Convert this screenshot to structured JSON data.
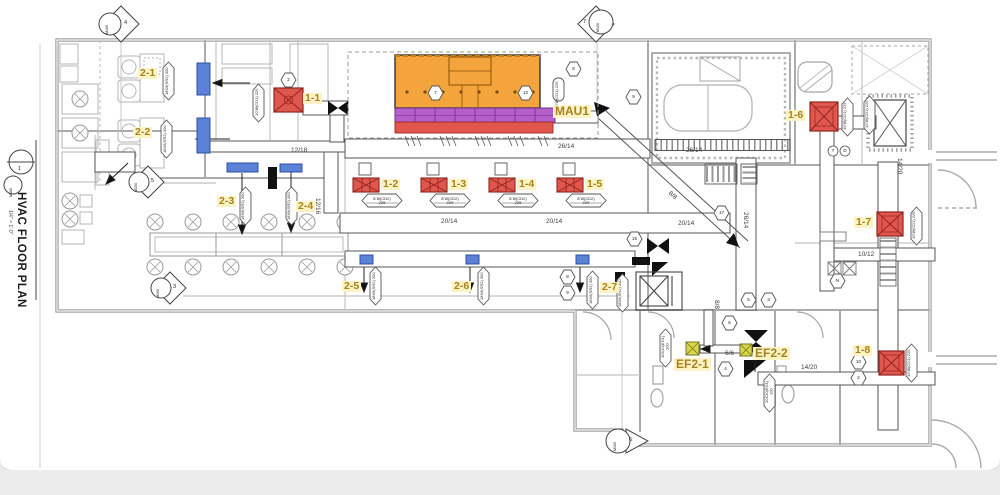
{
  "title_block": {
    "title": "HVAC FLOOR PLAN",
    "scale": "1/4\" = 1'-0\"",
    "callout_num": "1",
    "callout_sheet": "M100"
  },
  "equipment": {
    "d1_1": "1-1",
    "d1_2": "1-2",
    "d1_3": "1-3",
    "d1_4": "1-4",
    "d1_5": "1-5",
    "d1_6": "1-6",
    "d1_7": "1-7",
    "d1_8": "1-8",
    "r2_1": "2-1",
    "r2_2": "2-2",
    "r2_3": "2-3",
    "r2_4": "2-4",
    "r2_5": "2-5",
    "r2_6": "2-6",
    "r2_7": "2-7",
    "mau": "MAU1",
    "ef2_1": "EF2-1",
    "ef2_2": "EF2-2"
  },
  "duct_sizes": {
    "s12_18": "12/18",
    "s12_16": "12/16",
    "s26_14": "26/14",
    "s20_14": "20/14",
    "s8_8": "8/8",
    "s6_6": "6/6",
    "s14_20": "14/20",
    "s10_12": "10/12"
  },
  "diffuser_tag": {
    "line1": "8\"Ø(CD2)",
    "line2": "225"
  },
  "micro_tags": {
    "supply_register": "18X6(SR2) 300",
    "ceiling_diffuser": "10\"Ø(CD1) 225",
    "exhaust_grille": "10X10(EG1) 100"
  },
  "section_markers": {
    "sheet": "M100",
    "m_top_left": "4",
    "m_top_mid": "7",
    "m_left": "5",
    "m_left_low": "3",
    "m_bottom": "6"
  },
  "circle_tags": {
    "t": "T",
    "d": "D"
  },
  "hex_tags": {
    "h1": "2",
    "h2": "8",
    "h3": "9",
    "h4": "17",
    "h5": "15",
    "h6": "8",
    "h7": "9",
    "h8": "6",
    "h9": "4",
    "h10": "5",
    "h11": "3",
    "h12": "N",
    "h13": "10",
    "h14": "2",
    "h15": "7",
    "h16": "12"
  },
  "colors": {
    "hood_orange": "#f3a43c",
    "plenum_purple": "#b55fcc",
    "exhaust_red": "#e2574d",
    "diffuser_red": "#e0574e",
    "register_blue": "#5b82d6",
    "ef_yellow": "#d8d64d",
    "highlight": "#fcf3c5",
    "label_text": "#a8821e"
  }
}
